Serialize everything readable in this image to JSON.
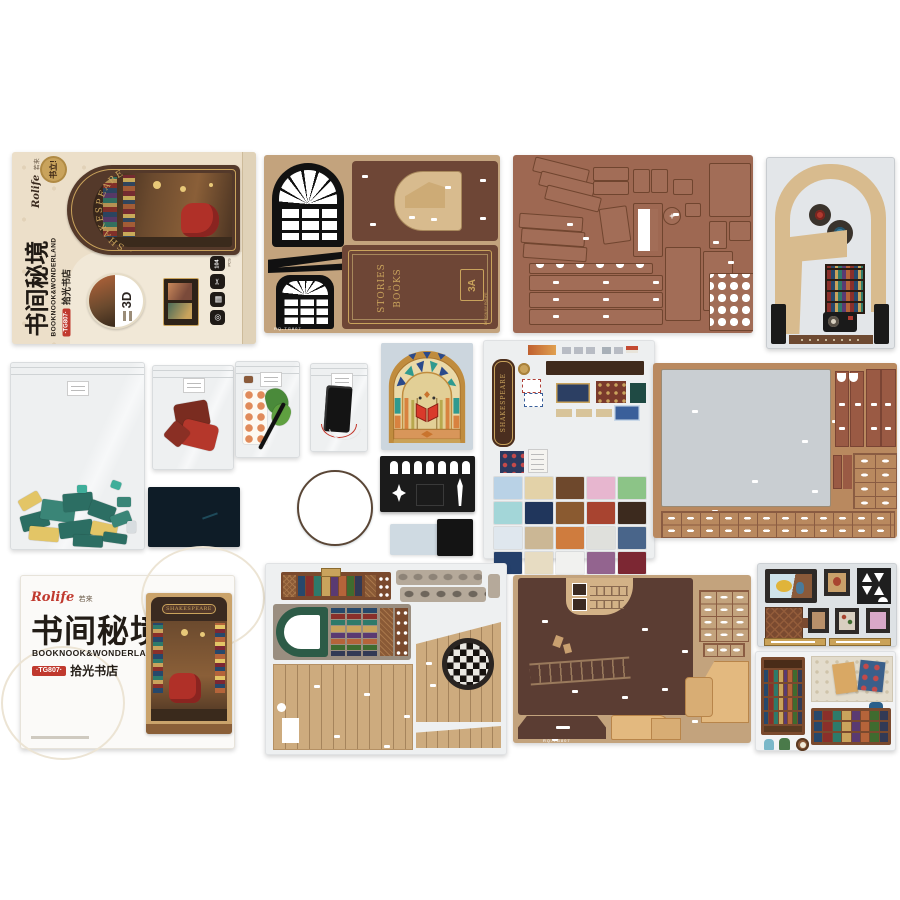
{
  "palette": {
    "page_bg": "#ffffff",
    "box_beige": "#ecdfc9",
    "box_beige_light": "#f1e8d7",
    "arch_brown": "#54392a",
    "gold": "#c9a35c",
    "brand_red": "#c0392e",
    "dark_text": "#2b2420",
    "sheet_tan": "#c3a37d",
    "panel_redbrown": "#6e4636",
    "parts_brown": "#9e6852",
    "gray_sheet": "#e3e6e9",
    "arch_tan": "#d8bb8e",
    "piece_teal": "#2c6e63",
    "piece_teal2": "#3a8577",
    "piece_yellow": "#e3c566",
    "piece_red": "#b5372b",
    "piece_darkred": "#7a2c20",
    "acrylic_navy": "#0e1c27",
    "glass_back": "#ccd6de",
    "glass_gold": "#c08c3e",
    "black_sheet": "#1b1b1b",
    "sticker_back": "#edeff0",
    "sign_brown": "#4a2e1f",
    "big_tan": "#b9895f",
    "big_gray": "#c9ced2",
    "plank_red": "#9a5a44",
    "booklet_white": "#fbfaf8",
    "floor_wood": "#cdab7e",
    "green_arch": "#2d5b47",
    "stone": "#a89a8a",
    "dark_panel": "#5b3d33",
    "light_cut": "#e3b97f",
    "frames_back": "#dee2e5",
    "frame_dark": "#2e2a28",
    "strip_gold": "#caa258",
    "shelf_brown": "#7a4a2e",
    "wallpaper": "#e3dccc"
  },
  "box": {
    "brand": "Rolife",
    "brand_cn": "若来",
    "badge": "书立!",
    "arch_title": "· SHAKESPEARE ·",
    "title_cn": "书间秘境",
    "title_en": "BOOKNOOK&WONDERLAND",
    "sku": "·TG807·",
    "subtitle": "拾光书店",
    "threeD": "3D",
    "icons": [
      {
        "glyph": "104",
        "label": "PCS"
      },
      {
        "glyph": "✂"
      },
      {
        "glyph": "▦"
      },
      {
        "glyph": "◎"
      }
    ]
  },
  "book_cover": {
    "title_top": "STORIES",
    "title_mid": "in",
    "title_bottom": "BOOKS",
    "logo": "3A",
    "logo_sub": "DESIGN BY ROLIFE"
  },
  "sticker_sheet": {
    "sign": "SHAKESPEARE",
    "tiles": [
      "#b9d2e6",
      "#e3d2a8",
      "#6e482c",
      "#e7b6cf",
      "#8cc487",
      "#a3d6d8",
      "#20365c",
      "#8a5a30",
      "#a84430",
      "#3c2a1e",
      "#dfe7ee",
      "#cbb795",
      "#cf7c3e",
      "#dfe0dc",
      "#49658a",
      "#25406b",
      "#e7dcc2",
      "#f1f1ef",
      "#93648f",
      "#7c2733"
    ]
  },
  "book_spines": [
    "#27486b",
    "#8a2f2a",
    "#2e7a6a",
    "#c9a35c",
    "#5a3a72",
    "#b5643a",
    "#3f6b2f",
    "#323a55"
  ],
  "booklet": {
    "brand": "Rolife",
    "brand_cn": "若来",
    "title_cn": "书间秘境",
    "title_en": "BOOKNOOK&WONDERLAND",
    "sku": "·TG807·",
    "subtitle": "拾光书店",
    "photo_sign": "SHAKESPEARE"
  },
  "codes": {
    "kit": "RQ-TG807"
  }
}
